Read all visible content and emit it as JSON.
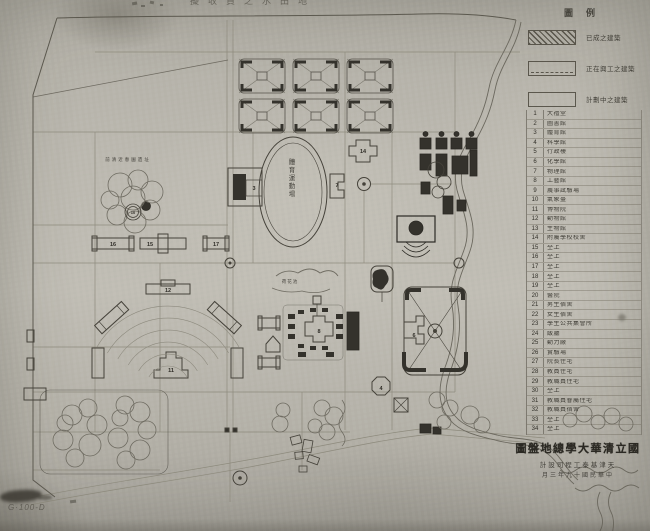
{
  "photo": {
    "corner_mark": "G·100-D"
  },
  "map": {
    "top_note": "擬收買之水田地",
    "grove_label": "前清近春園遺址",
    "oval_label": "體育運動場",
    "pond_label": "荷花池",
    "numbers": {
      "n3": "3",
      "n4": "4",
      "n6": "6",
      "n7": "7",
      "n8": "8",
      "n10": "10",
      "n11": "11",
      "n12": "12",
      "n14": "14",
      "n15": "15",
      "n16": "16",
      "n17": "17"
    }
  },
  "legend": {
    "title": "圖例",
    "items": [
      {
        "style": "hatched",
        "label": "已成之建築"
      },
      {
        "style": "outlined",
        "label": "正在興工之建築"
      },
      {
        "style": "plain",
        "label": "計劃中之建築"
      }
    ]
  },
  "building_list": {
    "rows": [
      {
        "no": "1",
        "name": "大禮堂"
      },
      {
        "no": "2",
        "name": "圖書館"
      },
      {
        "no": "3",
        "name": "體育館"
      },
      {
        "no": "4",
        "name": "科學館"
      },
      {
        "no": "5",
        "name": "行政樓"
      },
      {
        "no": "6",
        "name": "化學館"
      },
      {
        "no": "7",
        "name": "物理館"
      },
      {
        "no": "8",
        "name": "工藝館"
      },
      {
        "no": "9",
        "name": "農事試驗場"
      },
      {
        "no": "10",
        "name": "氣象臺"
      },
      {
        "no": "11",
        "name": "博物院"
      },
      {
        "no": "12",
        "name": "動物館"
      },
      {
        "no": "13",
        "name": "生物館"
      },
      {
        "no": "14",
        "name": "附屬學校校舍"
      },
      {
        "no": "15",
        "name": "仝上"
      },
      {
        "no": "16",
        "name": "仝上"
      },
      {
        "no": "17",
        "name": "仝上"
      },
      {
        "no": "18",
        "name": "仝上"
      },
      {
        "no": "19",
        "name": "仝上"
      },
      {
        "no": "20",
        "name": "醫院"
      },
      {
        "no": "21",
        "name": "男生宿舍"
      },
      {
        "no": "22",
        "name": "女生宿舍"
      },
      {
        "no": "23",
        "name": "學生公共集會所"
      },
      {
        "no": "24",
        "name": "飯廳"
      },
      {
        "no": "25",
        "name": "動力廠"
      },
      {
        "no": "26",
        "name": "實驗場"
      },
      {
        "no": "27",
        "name": "院長住宅"
      },
      {
        "no": "28",
        "name": "教員住宅"
      },
      {
        "no": "29",
        "name": "教職員住宅"
      },
      {
        "no": "30",
        "name": "仝上"
      },
      {
        "no": "31",
        "name": "教職員眷屬住宅"
      },
      {
        "no": "32",
        "name": "教職員宿舍"
      },
      {
        "no": "33",
        "name": "仝上"
      },
      {
        "no": "34",
        "name": "仝上"
      }
    ]
  },
  "title_block": {
    "title": "圖盤地總學大華清立國",
    "line2": "計設司程工泰基津天",
    "line3": "月三年九十國民華中"
  },
  "colors": {
    "paper": "#b5b2a9",
    "ink": "#3a382f",
    "dark_building": "#34322c",
    "road": "#8a8779"
  }
}
